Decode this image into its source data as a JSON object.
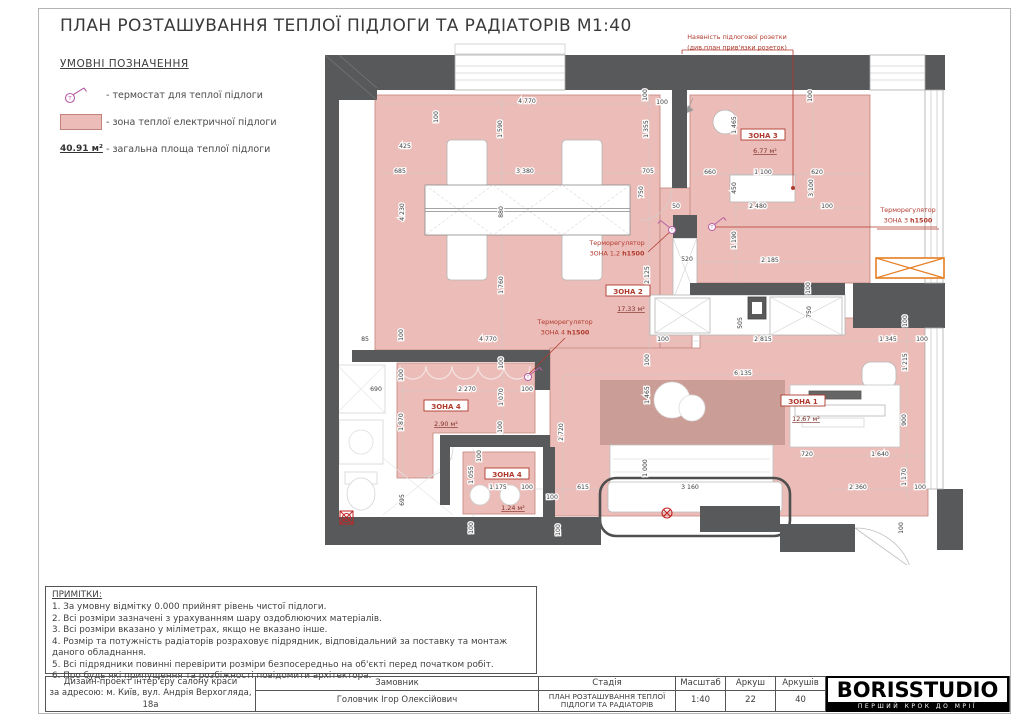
{
  "title": "ПЛАН РОЗТАШУВАННЯ ТЕПЛОЇ ПІДЛОГИ ТА РАДІАТОРІВ М1:40",
  "legend": {
    "heading": "УМОВНІ ПОЗНАЧЕННЯ",
    "items": [
      {
        "icon": "thermostat-icon",
        "label": "- термостат для теплої підлоги"
      },
      {
        "icon": "heated-zone-swatch",
        "label": "- зона теплої електричної підлоги"
      },
      {
        "icon": "total-area-value",
        "value": "40.91 м²",
        "label": "- загальна площа теплої підлоги"
      }
    ]
  },
  "plan": {
    "socket_note": {
      "lines": [
        "Наявність підлогової розетки",
        "(див.план прив'язки розеток)"
      ],
      "x": 412,
      "y": 11
    },
    "annotations": [
      {
        "lines": [
          "Терморегулятор",
          "ЗОНА 1,2 h1500"
        ],
        "x": 292,
        "y": 225
      },
      {
        "lines": [
          "Терморегулятор",
          "ЗОНА 3 h1500"
        ],
        "x": 583,
        "y": 192
      },
      {
        "lines": [
          "Терморегулятор",
          "ЗОНА 4 h1500"
        ],
        "x": 240,
        "y": 304
      }
    ],
    "zone_labels": [
      {
        "name": "ЗОНА 2",
        "area": "17.33 м²",
        "x": 303,
        "y": 273,
        "ax": 306,
        "ay": 291
      },
      {
        "name": "ЗОНА 3",
        "area": "6.77 м²",
        "x": 438,
        "y": 117,
        "ax": 440,
        "ay": 133
      },
      {
        "name": "ЗОНА 1",
        "area": "12.67 м²",
        "x": 478,
        "y": 383,
        "ax": 481,
        "ay": 401
      },
      {
        "name": "ЗОНА 4",
        "area": "2.90 м²",
        "x": 121,
        "y": 388,
        "ax": 121,
        "ay": 406
      },
      {
        "name": "ЗОНА 4",
        "area": "1.24 м²",
        "x": 182,
        "y": 456,
        "ax": 188,
        "ay": 490
      }
    ],
    "thermostats": [
      {
        "x": 347,
        "y": 210,
        "dir": -1
      },
      {
        "x": 387,
        "y": 207,
        "dir": 1
      },
      {
        "x": 203,
        "y": 357,
        "dir": 1
      }
    ],
    "dimensions": [
      {
        "t": "425",
        "x": 80,
        "y": 128
      },
      {
        "t": "100",
        "x": 113,
        "y": 97,
        "r": 1
      },
      {
        "t": "4 770",
        "x": 202,
        "y": 83
      },
      {
        "t": "100",
        "x": 322,
        "y": 75,
        "r": 1
      },
      {
        "t": "100",
        "x": 337,
        "y": 84
      },
      {
        "t": "1 590",
        "x": 177,
        "y": 109,
        "r": 1
      },
      {
        "t": "1 355",
        "x": 323,
        "y": 109,
        "r": 1
      },
      {
        "t": "685",
        "x": 75,
        "y": 153
      },
      {
        "t": "3 380",
        "x": 200,
        "y": 153
      },
      {
        "t": "705",
        "x": 323,
        "y": 153
      },
      {
        "t": "750",
        "x": 318,
        "y": 172,
        "r": 1
      },
      {
        "t": "4 230",
        "x": 79,
        "y": 192,
        "r": 1
      },
      {
        "t": "880",
        "x": 178,
        "y": 192,
        "r": 1
      },
      {
        "t": "1 760",
        "x": 178,
        "y": 265,
        "r": 1
      },
      {
        "t": "2 125",
        "x": 324,
        "y": 255,
        "r": 1
      },
      {
        "t": "50",
        "x": 351,
        "y": 188
      },
      {
        "t": "520",
        "x": 362,
        "y": 241
      },
      {
        "t": "1 190",
        "x": 411,
        "y": 220,
        "r": 1
      },
      {
        "t": "1 465",
        "x": 411,
        "y": 105,
        "r": 1
      },
      {
        "t": "100",
        "x": 487,
        "y": 76,
        "r": 1
      },
      {
        "t": "660",
        "x": 385,
        "y": 154
      },
      {
        "t": "1 100",
        "x": 438,
        "y": 154
      },
      {
        "t": "620",
        "x": 492,
        "y": 154
      },
      {
        "t": "450",
        "x": 411,
        "y": 168,
        "r": 1
      },
      {
        "t": "3 100",
        "x": 488,
        "y": 168,
        "r": 1
      },
      {
        "t": "2 480",
        "x": 433,
        "y": 188
      },
      {
        "t": "100",
        "x": 502,
        "y": 188
      },
      {
        "t": "2 185",
        "x": 445,
        "y": 242
      },
      {
        "t": "100",
        "x": 485,
        "y": 268,
        "r": 1
      },
      {
        "t": "100",
        "x": 338,
        "y": 321
      },
      {
        "t": "505",
        "x": 417,
        "y": 303,
        "r": 1
      },
      {
        "t": "750",
        "x": 486,
        "y": 292,
        "r": 1
      },
      {
        "t": "2 815",
        "x": 438,
        "y": 321
      },
      {
        "t": "1 345",
        "x": 563,
        "y": 321
      },
      {
        "t": "100",
        "x": 597,
        "y": 321
      },
      {
        "t": "100",
        "x": 582,
        "y": 301,
        "r": 1
      },
      {
        "t": "1 215",
        "x": 582,
        "y": 342,
        "r": 1
      },
      {
        "t": "6 135",
        "x": 418,
        "y": 355
      },
      {
        "t": "100",
        "x": 324,
        "y": 340,
        "r": 1
      },
      {
        "t": "1 465",
        "x": 324,
        "y": 375,
        "r": 1
      },
      {
        "t": "900",
        "x": 581,
        "y": 400,
        "r": 1
      },
      {
        "t": "720",
        "x": 482,
        "y": 436
      },
      {
        "t": "1 640",
        "x": 555,
        "y": 436
      },
      {
        "t": "1 170",
        "x": 581,
        "y": 457,
        "r": 1
      },
      {
        "t": "2 360",
        "x": 533,
        "y": 469
      },
      {
        "t": "100",
        "x": 595,
        "y": 469
      },
      {
        "t": "100",
        "x": 578,
        "y": 508,
        "r": 1
      },
      {
        "t": "85",
        "x": 40,
        "y": 321
      },
      {
        "t": "100",
        "x": 78,
        "y": 315,
        "r": 1
      },
      {
        "t": "4 770",
        "x": 163,
        "y": 321
      },
      {
        "t": "100",
        "x": 178,
        "y": 343,
        "r": 1
      },
      {
        "t": "690",
        "x": 51,
        "y": 371
      },
      {
        "t": "100",
        "x": 78,
        "y": 355,
        "r": 1
      },
      {
        "t": "2 270",
        "x": 142,
        "y": 371
      },
      {
        "t": "100",
        "x": 202,
        "y": 371
      },
      {
        "t": "1 070",
        "x": 178,
        "y": 377,
        "r": 1
      },
      {
        "t": "1 870",
        "x": 78,
        "y": 402,
        "r": 1
      },
      {
        "t": "100",
        "x": 177,
        "y": 407,
        "r": 1
      },
      {
        "t": "2 720",
        "x": 238,
        "y": 412,
        "r": 1
      },
      {
        "t": "1 055",
        "x": 148,
        "y": 455,
        "r": 1
      },
      {
        "t": "100",
        "x": 156,
        "y": 436,
        "r": 1
      },
      {
        "t": "1 175",
        "x": 173,
        "y": 469
      },
      {
        "t": "100",
        "x": 202,
        "y": 469
      },
      {
        "t": "615",
        "x": 258,
        "y": 469
      },
      {
        "t": "100",
        "x": 227,
        "y": 479
      },
      {
        "t": "695",
        "x": 79,
        "y": 480,
        "r": 1
      },
      {
        "t": "100",
        "x": 148,
        "y": 508,
        "r": 1
      },
      {
        "t": "100",
        "x": 235,
        "y": 510,
        "r": 1
      },
      {
        "t": "1 000",
        "x": 322,
        "y": 448,
        "r": 1
      },
      {
        "t": "3 160",
        "x": 365,
        "y": 469
      }
    ]
  },
  "notes": {
    "heading": "ПРИМІТКИ:",
    "items": [
      "1. За умовну відмітку 0.000 прийнят рівень чистої підлоги.",
      "2. Всі розміри зазначені з урахуванням шару оздоблюючих матеріалів.",
      "3. Всі розміри вказано у міліметрах, якщо не вказано інше.",
      "4.  Розмір та потужність радіаторів розраховує підрядник, відповідальний за поставку та монтаж даного обладнання.",
      "5. Всі підрядники повинні перевірити розміри безпосередньо на об'єкті перед початком робіт.",
      "6. Про будь які припущення та розбіжності повідомити архітектора."
    ]
  },
  "title_block": {
    "project_line1": "Дизайн-проект інтер'єру салону краси",
    "project_line2": "за адресою: м. Київ, вул. Андрія Верхогляда, 18а",
    "customer_label": "Замовник",
    "customer_value": "Головчик Ігор Олексійович",
    "stage_label": "Стадія",
    "stage_value": "ПЛАН РОЗТАШУВАННЯ ТЕПЛОЇ ПІДЛОГИ ТА РАДІАТОРІВ",
    "scale_label": "Масштаб",
    "scale_value": "1:40",
    "sheet_label": "Аркуш",
    "sheet_value": "22",
    "sheets_label": "Аркушів",
    "sheets_value": "40",
    "logo": "BORISSTUDIO",
    "slogan": "ПЕРШИЙ КРОК ДО МРІЇ"
  },
  "colors": {
    "wall": "#58595b",
    "zone_fill": "#ecbdb8",
    "zone_border": "#c4827c",
    "annotation_red": "#b03a2e",
    "thermostat_magenta": "#b75fa5",
    "radiator_orange": "#e67e22"
  }
}
